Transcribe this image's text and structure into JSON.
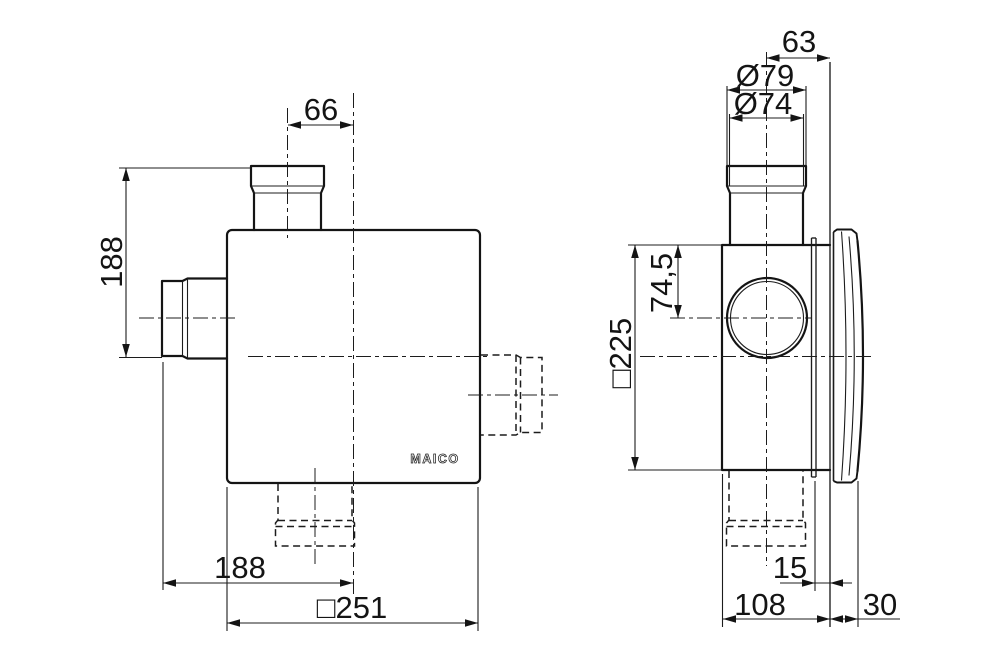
{
  "drawing": {
    "brand": "MAICO",
    "views": {
      "front": {
        "dimensions": {
          "top_duct_offset": "66",
          "side_duct_height": "188",
          "width_to_center": "188",
          "body_square": "□251"
        }
      },
      "side": {
        "dimensions": {
          "duct_center_to_wall": "63",
          "duct_outer_diameter": "Ø79",
          "duct_inner_diameter": "Ø74",
          "duct_center_from_top": "74,5",
          "face_square": "□225",
          "flange_to_wall": "15",
          "housing_depth": "108",
          "cover_depth": "30"
        }
      }
    }
  }
}
